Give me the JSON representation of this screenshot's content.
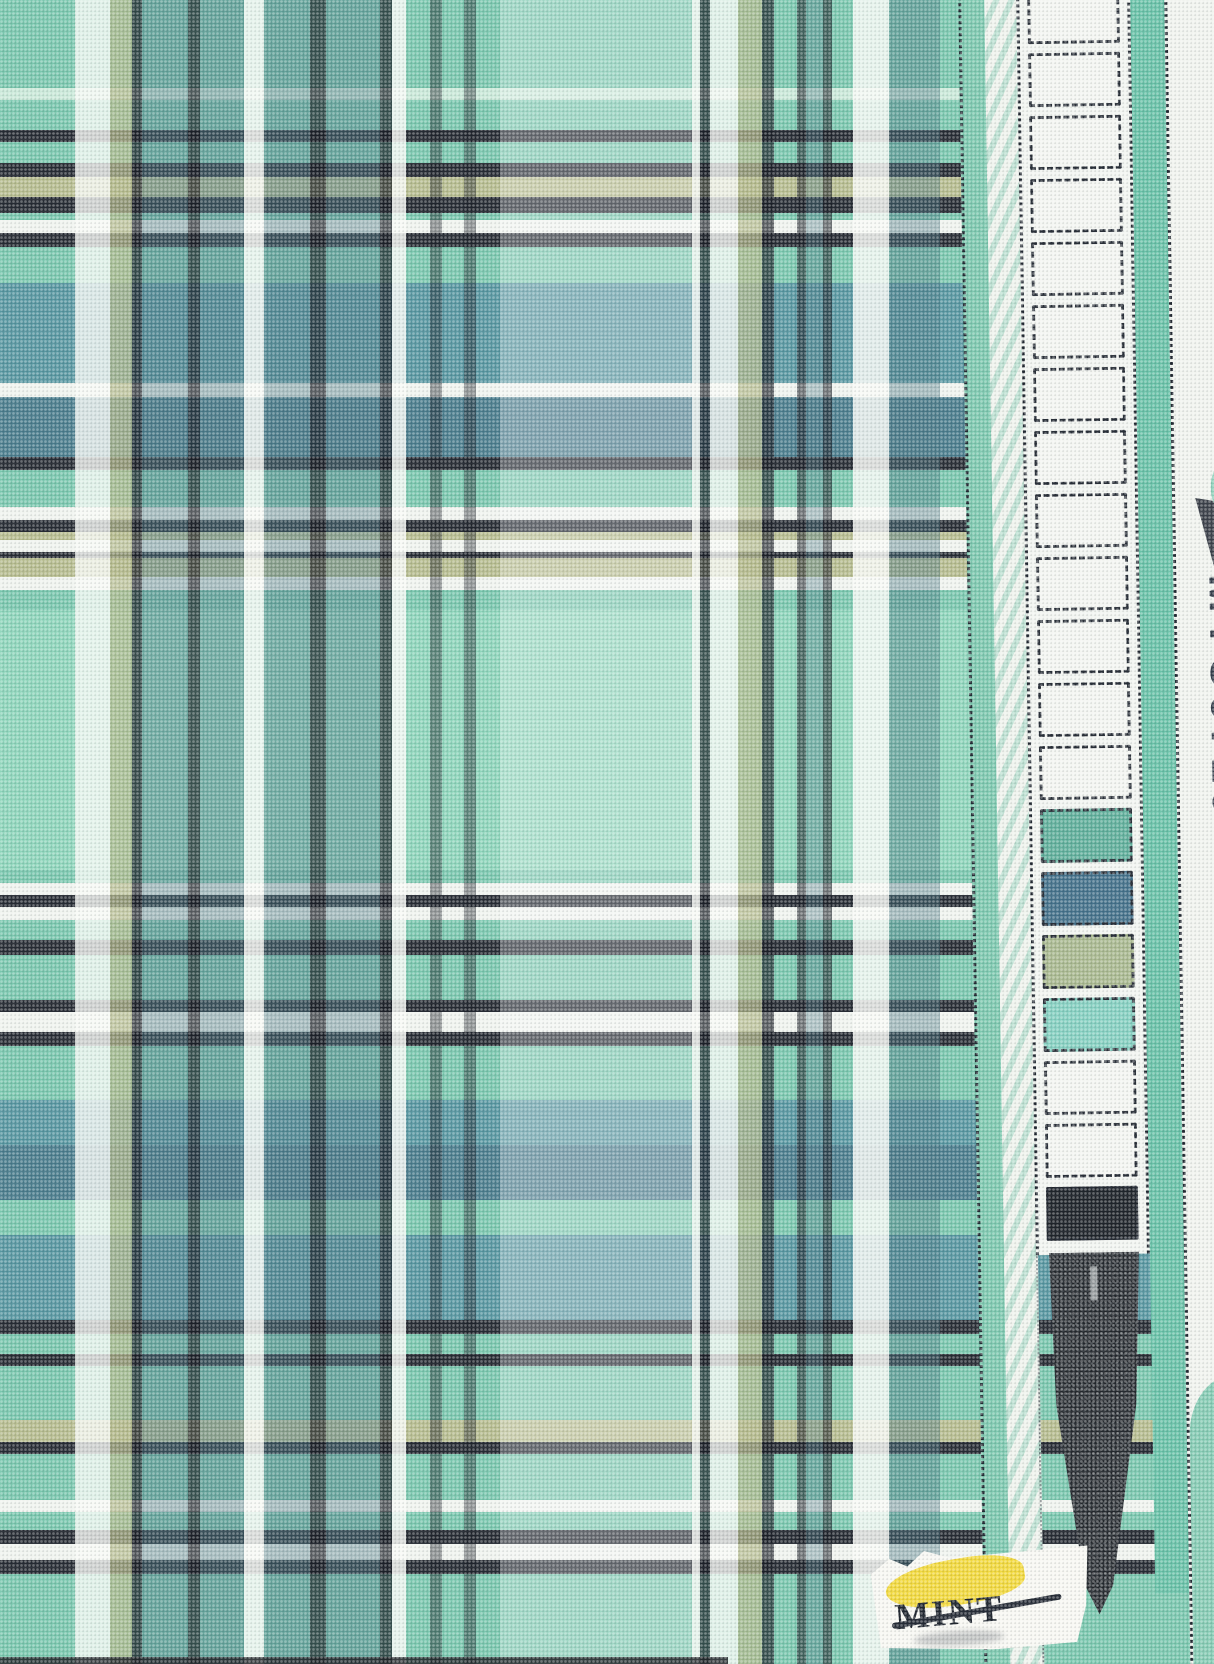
{
  "meta": {
    "kind": "fabric-swatch-scan",
    "description": "Mint green tartan plaid woven fabric with selvedge"
  },
  "fabric": {
    "base_color": "#79c6ad",
    "palette": {
      "mint": "#79c6ad",
      "mint_light": "#8dd4ba",
      "pale_mint": "#c9e8d8",
      "teal": "#5796a0",
      "teal_dark": "#4a7c8c",
      "dark": "#262b33",
      "white": "#eff3ee",
      "olive": "#b5bb8e",
      "aqua": "#97d6c9"
    },
    "h_bands": [
      [
        "#79c6ad",
        88
      ],
      [
        "#c9e8d8",
        12
      ],
      [
        "#79c6ad",
        30
      ],
      [
        "#262b33",
        12
      ],
      [
        "#79c6ad",
        21
      ],
      [
        "#262b33",
        14
      ],
      [
        "#b5bb8e",
        20
      ],
      [
        "#262b33",
        16
      ],
      [
        "#79c6ad",
        7
      ],
      [
        "#eff3ee",
        13
      ],
      [
        "#262b33",
        14
      ],
      [
        "#79c6ad",
        36
      ],
      [
        "#5796a0",
        100
      ],
      [
        "#eff3ee",
        14
      ],
      [
        "#4a7c8c",
        60
      ],
      [
        "#262b33",
        13
      ],
      [
        "#79c6ad",
        37
      ],
      [
        "#eff3ee",
        13
      ],
      [
        "#262b33",
        12
      ],
      [
        "#b5bb8e",
        8
      ],
      [
        "#eff3ee",
        12
      ],
      [
        "#262b33",
        6
      ],
      [
        "#b5bb8e",
        19
      ],
      [
        "#eff3ee",
        13
      ],
      [
        "#79c6ad",
        20
      ],
      [
        "#8dd4ba",
        260
      ],
      [
        "#79c6ad",
        13
      ],
      [
        "#eff3ee",
        12
      ],
      [
        "#262b33",
        12
      ],
      [
        "#eff3ee",
        13
      ],
      [
        "#79c6ad",
        20
      ],
      [
        "#262b33",
        15
      ],
      [
        "#79c6ad",
        45
      ],
      [
        "#262b33",
        12
      ],
      [
        "#eff3ee",
        20
      ],
      [
        "#262b33",
        14
      ],
      [
        "#79c6ad",
        54
      ],
      [
        "#5796a0",
        45
      ],
      [
        "#4a7c8c",
        55
      ],
      [
        "#79c6ad",
        35
      ],
      [
        "#5796a0",
        85
      ],
      [
        "#262b33",
        14
      ],
      [
        "#79c6ad",
        20
      ],
      [
        "#262b33",
        12
      ],
      [
        "#79c6ad",
        54
      ],
      [
        "#b5bb8e",
        22
      ],
      [
        "#262b33",
        12
      ],
      [
        "#79c6ad",
        46
      ],
      [
        "#eff3ee",
        12
      ],
      [
        "#79c6ad",
        18
      ],
      [
        "#262b33",
        14
      ],
      [
        "#eff3ee",
        16
      ],
      [
        "#262b33",
        14
      ],
      [
        "#79c6ad",
        90
      ]
    ],
    "v_bands": [
      [
        "rgba(0,0,0,0)",
        75
      ],
      [
        "rgba(248,250,246,0.80)",
        35
      ],
      [
        "rgba(178,184,138,0.75)",
        22
      ],
      [
        "rgba(24,28,36,0.75)",
        10
      ],
      [
        "rgba(73,118,130,0.45)",
        46
      ],
      [
        "rgba(24,28,36,0.70)",
        12
      ],
      [
        "rgba(73,118,130,0.45)",
        44
      ],
      [
        "rgba(248,250,246,0.85)",
        20
      ],
      [
        "rgba(73,118,130,0.45)",
        46
      ],
      [
        "rgba(24,28,36,0.70)",
        16
      ],
      [
        "rgba(73,118,130,0.45)",
        54
      ],
      [
        "rgba(24,28,36,0.70)",
        12
      ],
      [
        "rgba(248,250,246,0.85)",
        14
      ],
      [
        "rgba(0,0,0,0)",
        24
      ],
      [
        "rgba(24,28,36,0.45)",
        12
      ],
      [
        "rgba(0,0,0,0)",
        22
      ],
      [
        "rgba(24,28,36,0.45)",
        12
      ],
      [
        "rgba(0,0,0,0)",
        24
      ],
      [
        "rgba(255,255,255,0.28)",
        192
      ],
      [
        "rgba(248,250,246,0.85)",
        8
      ],
      [
        "rgba(24,28,36,0.70)",
        10
      ],
      [
        "rgba(248,250,246,0.80)",
        28
      ],
      [
        "rgba(178,184,138,0.75)",
        24
      ],
      [
        "rgba(24,28,36,0.70)",
        12
      ],
      [
        "rgba(0,0,0,0)",
        23
      ],
      [
        "rgba(24,28,36,0.60)",
        9
      ],
      [
        "rgba(73,118,130,0.40)",
        17
      ],
      [
        "rgba(24,28,36,0.60)",
        9
      ],
      [
        "rgba(0,0,0,0)",
        21
      ],
      [
        "rgba(248,250,246,0.85)",
        36
      ],
      [
        "rgba(73,118,130,0.45)",
        51
      ],
      [
        "rgba(0,0,0,0)",
        35
      ],
      [
        "rgba(0,0,0,0)",
        239
      ]
    ]
  },
  "selvedge": {
    "code": "MYC6710",
    "code_color": "#343d4a",
    "green_stripe_color": "#68c1a7",
    "triangle_color": "#2b313b",
    "strip_bg": "#f1f4f0",
    "tip_color": "#22262b",
    "boxes": [
      "#f3f5f1",
      "#f3f5f1",
      "#f3f5f1",
      "#f3f5f1",
      "#f3f5f1",
      "#f3f5f1",
      "#f3f5f1",
      "#f3f5f1",
      "#f3f5f1",
      "#f3f5f1",
      "#f3f5f1",
      "#f3f5f1",
      "#f3f5f1",
      "#5fae9a",
      "#44718a",
      "#a8b88f",
      "#85cfc0",
      "#f3f5f1",
      "#f3f5f1",
      "#1f242a"
    ]
  },
  "label": {
    "text": "MINT",
    "text_color": "#20262f",
    "sticker_color": "#f7f7f2",
    "highlight_color": "#f0d634"
  }
}
